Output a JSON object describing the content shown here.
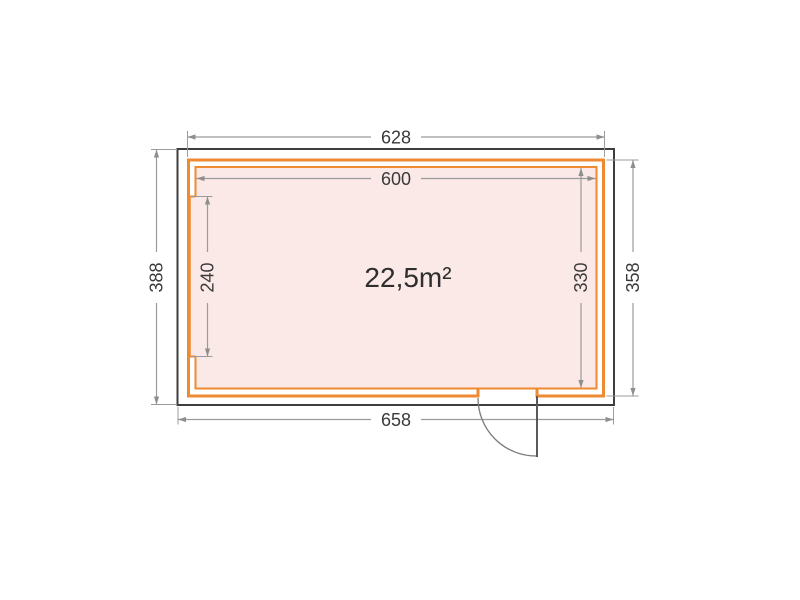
{
  "plan": {
    "area": "22,5m²",
    "dimensions": {
      "top": "628",
      "inner_top": "600",
      "bottom": "658",
      "left": "388",
      "left_inner": "240",
      "right_inner": "330",
      "right": "358"
    },
    "colors": {
      "wall_orange": "#ee8a31",
      "room_fill_pink": "#fae9e7",
      "roof_outline": "#3e3e3e",
      "dimension_gray": "#9b9b9b",
      "text_dark": "#3a3a3a"
    }
  }
}
